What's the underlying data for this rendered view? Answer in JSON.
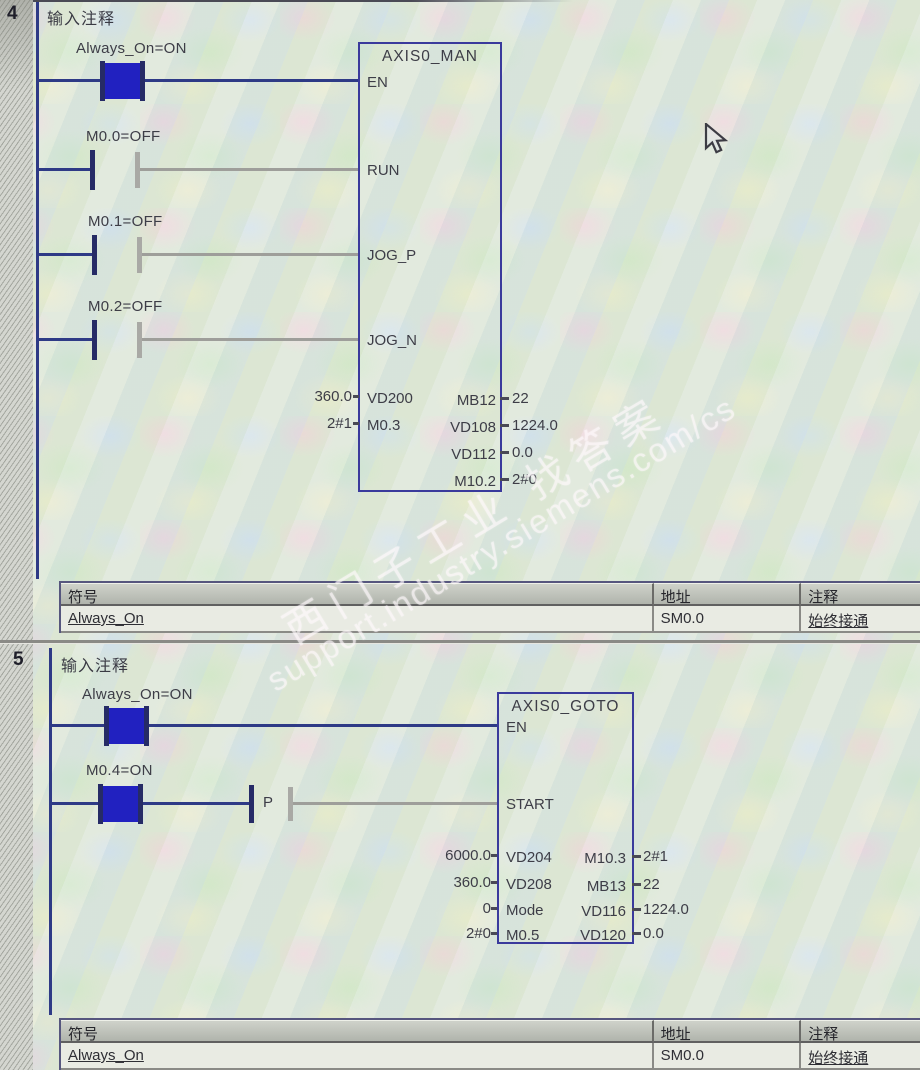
{
  "app": {
    "view": "ladder-program-status-view"
  },
  "colors": {
    "powered_wire": "#2e3a86",
    "unpowered_wire": "#9e9e9a",
    "contact_on_fill": "#2121c0",
    "block_border": "#3a3a9c"
  },
  "watermark": {
    "zh": "西门子工业 找答案",
    "url": "support.industry.siemens.com/cs"
  },
  "networks": [
    {
      "number": "4",
      "title": "输入注释",
      "contacts": [
        {
          "label": "Always_On=ON",
          "state": "on"
        },
        {
          "label": "M0.0=OFF",
          "state": "off"
        },
        {
          "label": "M0.1=OFF",
          "state": "off"
        },
        {
          "label": "M0.2=OFF",
          "state": "off"
        }
      ],
      "block": {
        "name": "AXIS0_MAN",
        "inputs": [
          "EN",
          "RUN",
          "JOG_P",
          "JOG_N"
        ],
        "params_left": [
          {
            "value": "360.0",
            "pin": "VD200"
          },
          {
            "value": "2#1",
            "pin": "M0.3"
          }
        ],
        "params_right": [
          {
            "pin": "MB12",
            "value": "22"
          },
          {
            "pin": "VD108",
            "value": "1224.0"
          },
          {
            "pin": "VD112",
            "value": "0.0"
          },
          {
            "pin": "M10.2",
            "value": "2#0"
          }
        ]
      },
      "symbol_table": {
        "headers": [
          "符号",
          "地址",
          "注释"
        ],
        "rows": [
          [
            "Always_On",
            "SM0.0",
            "始终接通"
          ]
        ]
      }
    },
    {
      "number": "5",
      "title": "输入注释",
      "contacts": [
        {
          "label": "Always_On=ON",
          "state": "on"
        },
        {
          "label": "M0.4=ON",
          "state": "on"
        },
        {
          "label": "P",
          "state": "edge"
        }
      ],
      "block": {
        "name": "AXIS0_GOTO",
        "inputs": [
          "EN",
          "START"
        ],
        "params_left": [
          {
            "value": "6000.0",
            "pin": "VD204"
          },
          {
            "value": "360.0",
            "pin": "VD208"
          },
          {
            "value": "0",
            "pin": "Mode"
          },
          {
            "value": "2#0",
            "pin": "M0.5"
          }
        ],
        "params_right": [
          {
            "pin": "M10.3",
            "value": "2#1"
          },
          {
            "pin": "MB13",
            "value": "22"
          },
          {
            "pin": "VD116",
            "value": "1224.0"
          },
          {
            "pin": "VD120",
            "value": "0.0"
          }
        ]
      },
      "symbol_table": {
        "headers": [
          "符号",
          "地址",
          "注释"
        ],
        "rows": [
          [
            "Always_On",
            "SM0.0",
            "始终接通"
          ]
        ]
      }
    }
  ]
}
